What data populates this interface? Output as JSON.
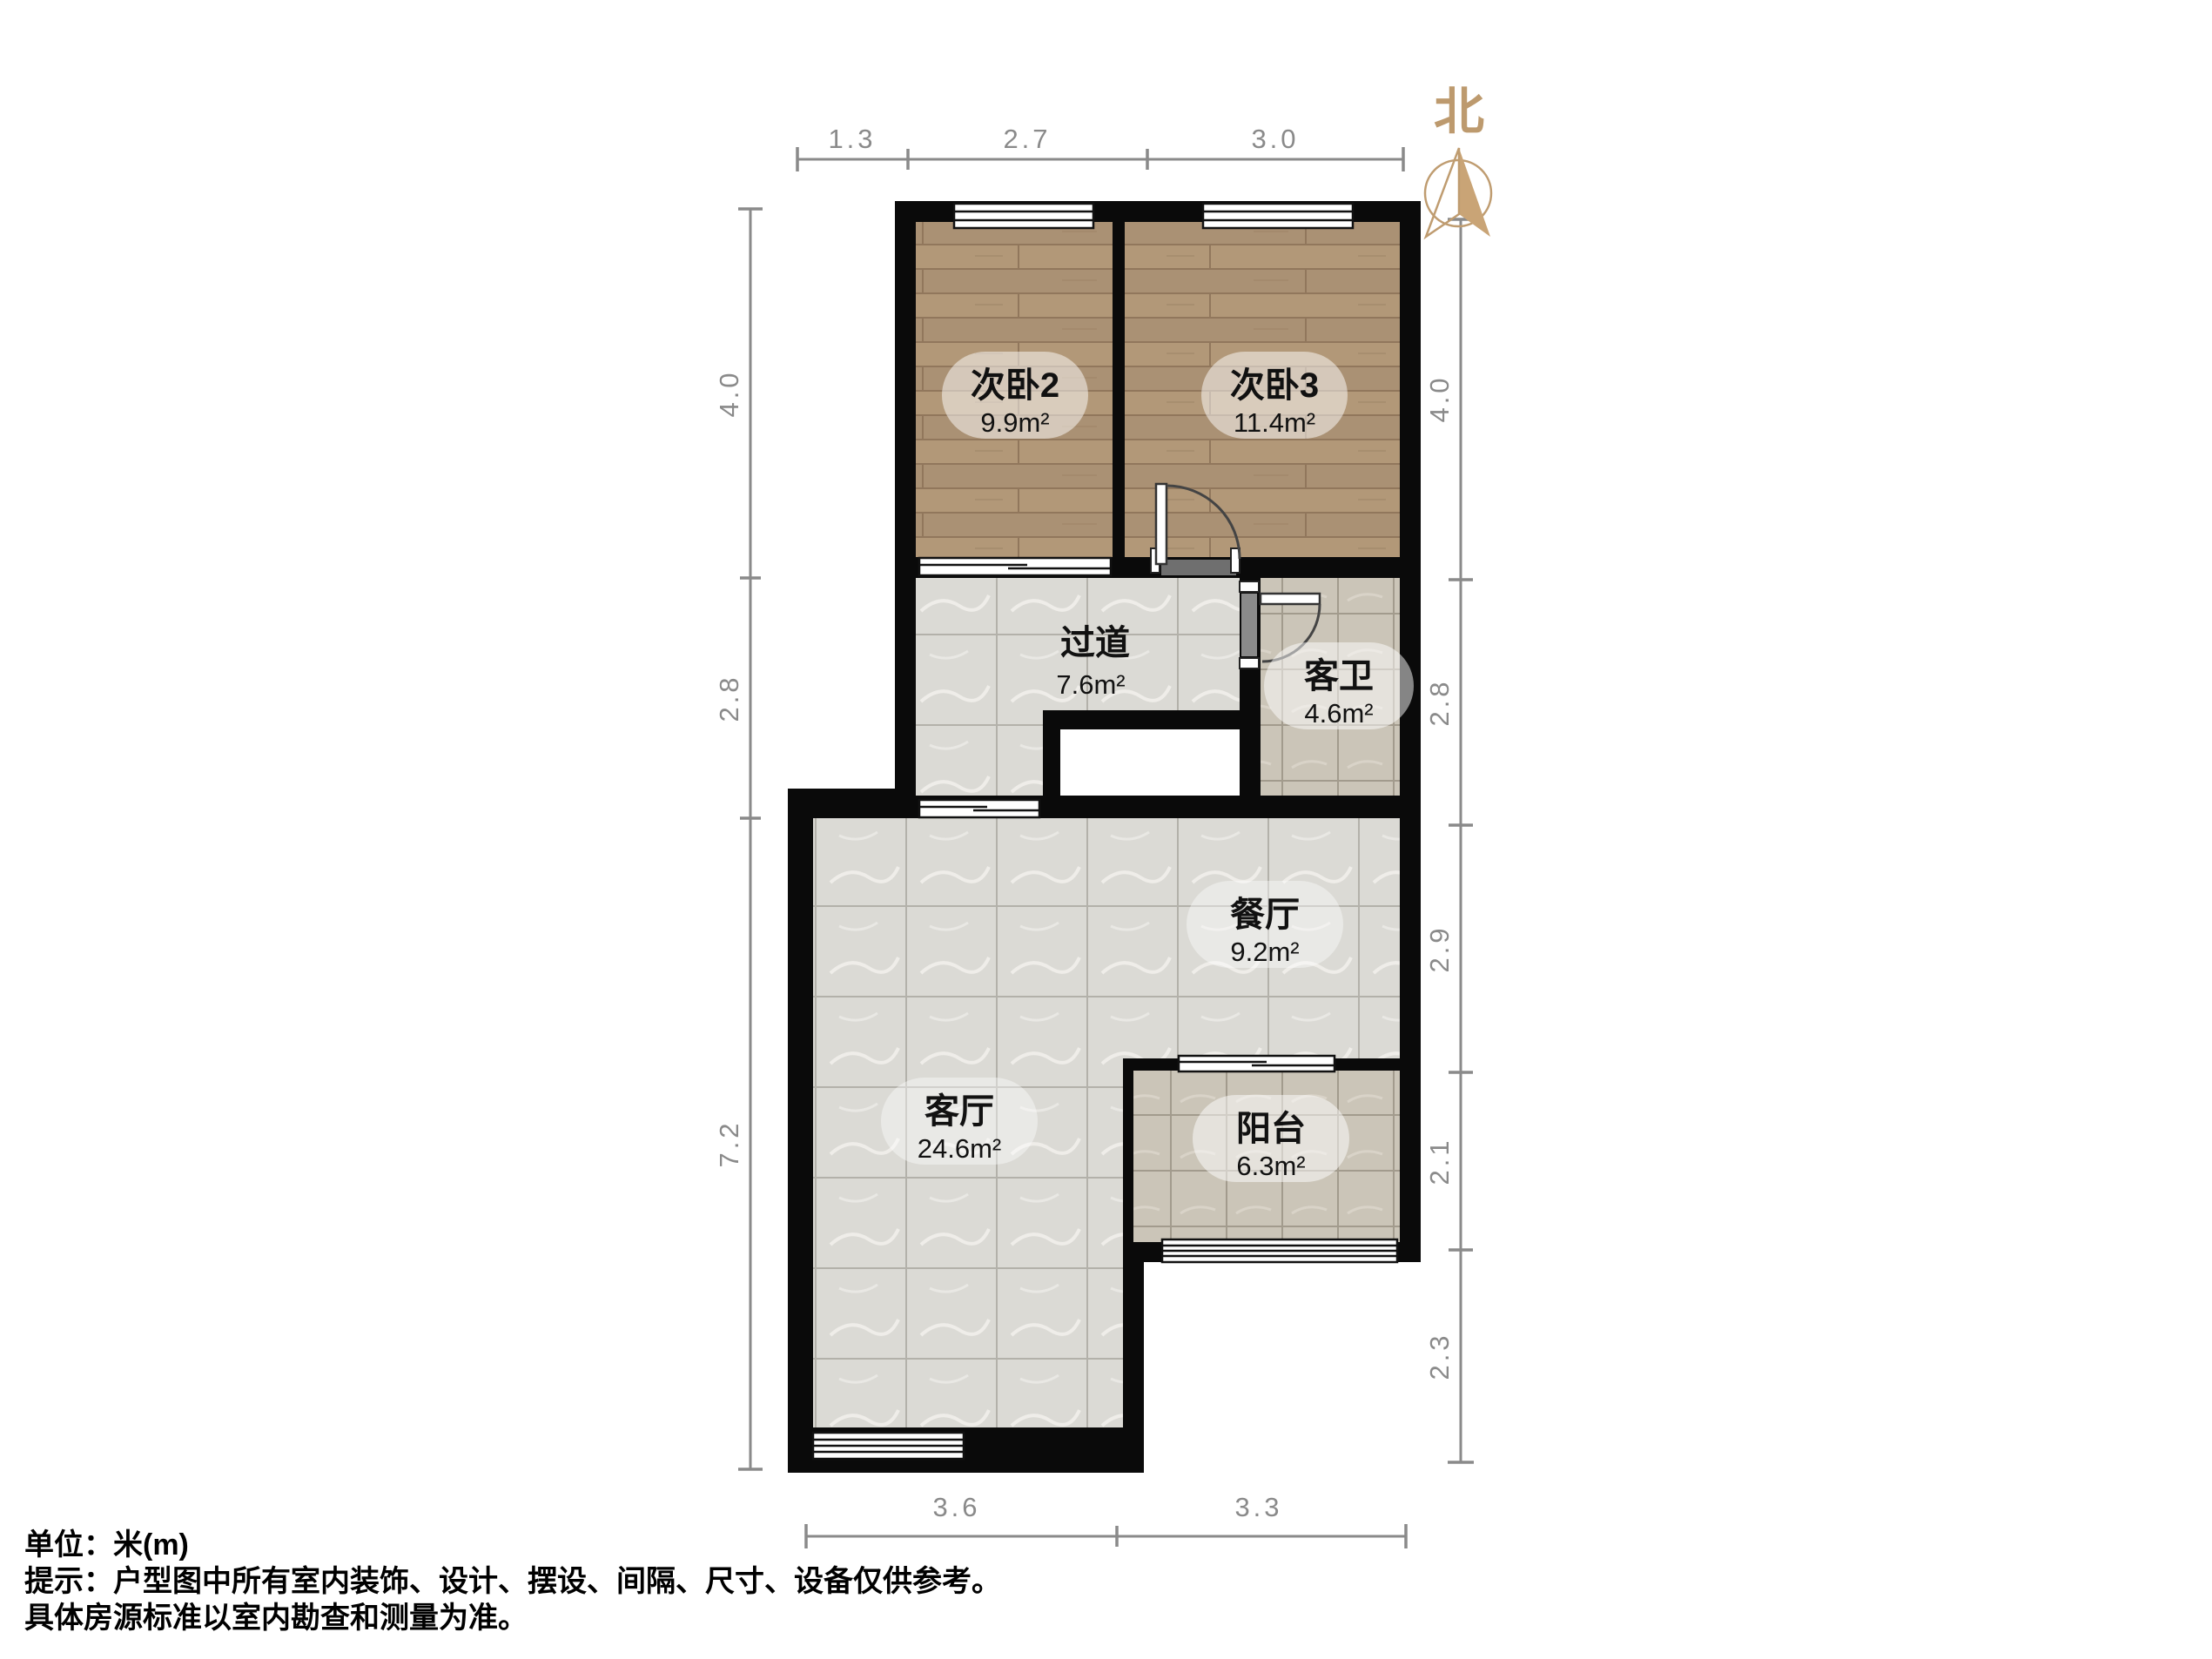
{
  "title": "户型图",
  "compass": {
    "label": "北"
  },
  "rooms": [
    {
      "id": "bedroom2",
      "name": "次卧2",
      "area": "9.9m²"
    },
    {
      "id": "bedroom3",
      "name": "次卧3",
      "area": "11.4m²"
    },
    {
      "id": "hallway",
      "name": "过道",
      "area": "7.6m²"
    },
    {
      "id": "bathroom",
      "name": "客卫",
      "area": "4.6m²"
    },
    {
      "id": "dining",
      "name": "餐厅",
      "area": "9.2m²"
    },
    {
      "id": "living",
      "name": "客厅",
      "area": "24.6m²"
    },
    {
      "id": "balcony",
      "name": "阳台",
      "area": "6.3m²"
    }
  ],
  "dimensions": {
    "top": [
      "1.3",
      "2.7",
      "3.0"
    ],
    "left": [
      "4.0",
      "2.8",
      "7.2"
    ],
    "right": [
      "4.0",
      "2.8",
      "2.9",
      "2.1",
      "2.3"
    ],
    "bottom": [
      "3.6",
      "3.3"
    ]
  },
  "notes": [
    "单位：米(m)",
    "提示：户型图中所有室内装饰、设计、摆设、间隔、尺寸、设备仅供参考。",
    "具体房源标准以室内勘查和测量为准。"
  ],
  "colors": {
    "wall": "#0a0a0a",
    "wood_floor": "#b29878",
    "marble_floor": "#dbdad5",
    "tile_floor": "#cbc5b8",
    "dimension": "#8a8a8a",
    "compass_accent": "#bf9c70"
  }
}
